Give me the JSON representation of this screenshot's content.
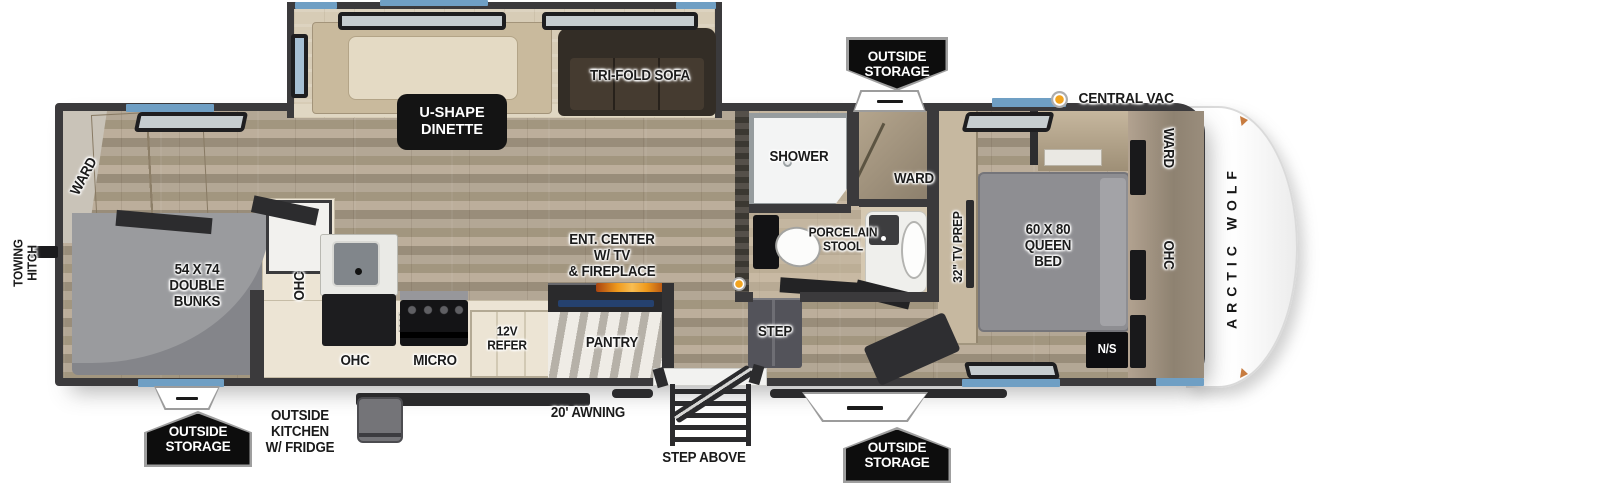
{
  "colors": {
    "wall": "#3b3a3c",
    "floor_wood": "#ab9f8d",
    "slide_floor": "#d7ccb6",
    "window_blue": "#6f9fc4",
    "badge_bg": "#0d0d0d",
    "vac_orange": "#f2a41f",
    "fireplace_orange": "#ef9a1d"
  },
  "brand": "ARCTIC WOLF",
  "badges": {
    "outside_storage": "OUTSIDE\nSTORAGE"
  },
  "exterior": {
    "central_vac": "CENTRAL VAC",
    "towing_hitch": "TOWING\nHITCH",
    "awning": "20' AWNING",
    "step_above": "STEP ABOVE",
    "outside_kitchen": "OUTSIDE\nKITCHEN\nW/ FRIDGE"
  },
  "slideout": {
    "dinette": "U-SHAPE\nDINETTE",
    "sofa": "TRI-FOLD SOFA"
  },
  "rear": {
    "ward": "WARD",
    "bunks": "54 X 74\nDOUBLE\nBUNKS"
  },
  "kitchen": {
    "ohc_upper": "OHC",
    "ohc_lower": "OHC",
    "micro": "MICRO",
    "refer": "12V\nREFER",
    "pantry": "PANTRY",
    "ent_center": "ENT. CENTER\nW/ TV\n& FIREPLACE"
  },
  "bath": {
    "shower": "SHOWER",
    "stool": "PORCELAIN\nSTOOL",
    "ward": "WARD",
    "step": "STEP"
  },
  "bedroom": {
    "tv_prep": "32\" TV PREP",
    "bed": "60 X 80\nQUEEN\nBED",
    "nightstand": "N/S",
    "ward_front": "WARD",
    "ohc_front": "OHC"
  }
}
